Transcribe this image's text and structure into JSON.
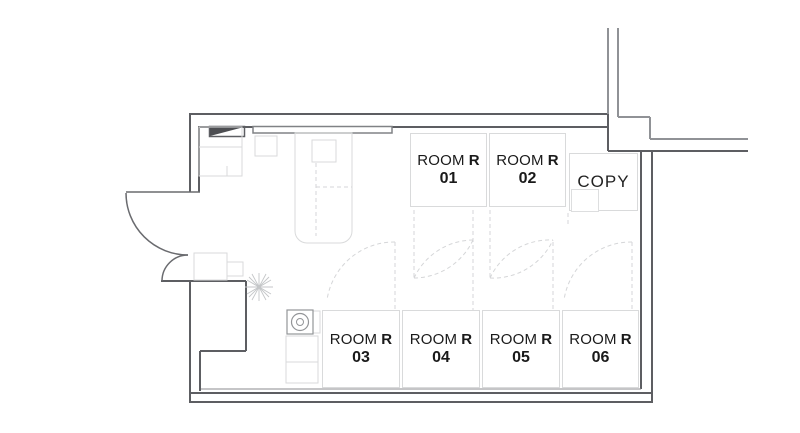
{
  "rooms": [
    {
      "label": "ROOM",
      "tag": "R",
      "number": "01"
    },
    {
      "label": "ROOM",
      "tag": "R",
      "number": "02"
    },
    {
      "label": "ROOM",
      "tag": "R",
      "number": "03"
    },
    {
      "label": "ROOM",
      "tag": "R",
      "number": "04"
    },
    {
      "label": "ROOM",
      "tag": "R",
      "number": "05"
    },
    {
      "label": "ROOM",
      "tag": "R",
      "number": "06"
    }
  ],
  "copy_label": "COPY",
  "colors": {
    "wall": "#5d5e62",
    "corridor_wall": "#909296",
    "room_border": "#d9dadb",
    "furniture": "#d9dadb",
    "dashed": "#d5d6d8",
    "text": "#1a1a1a"
  }
}
